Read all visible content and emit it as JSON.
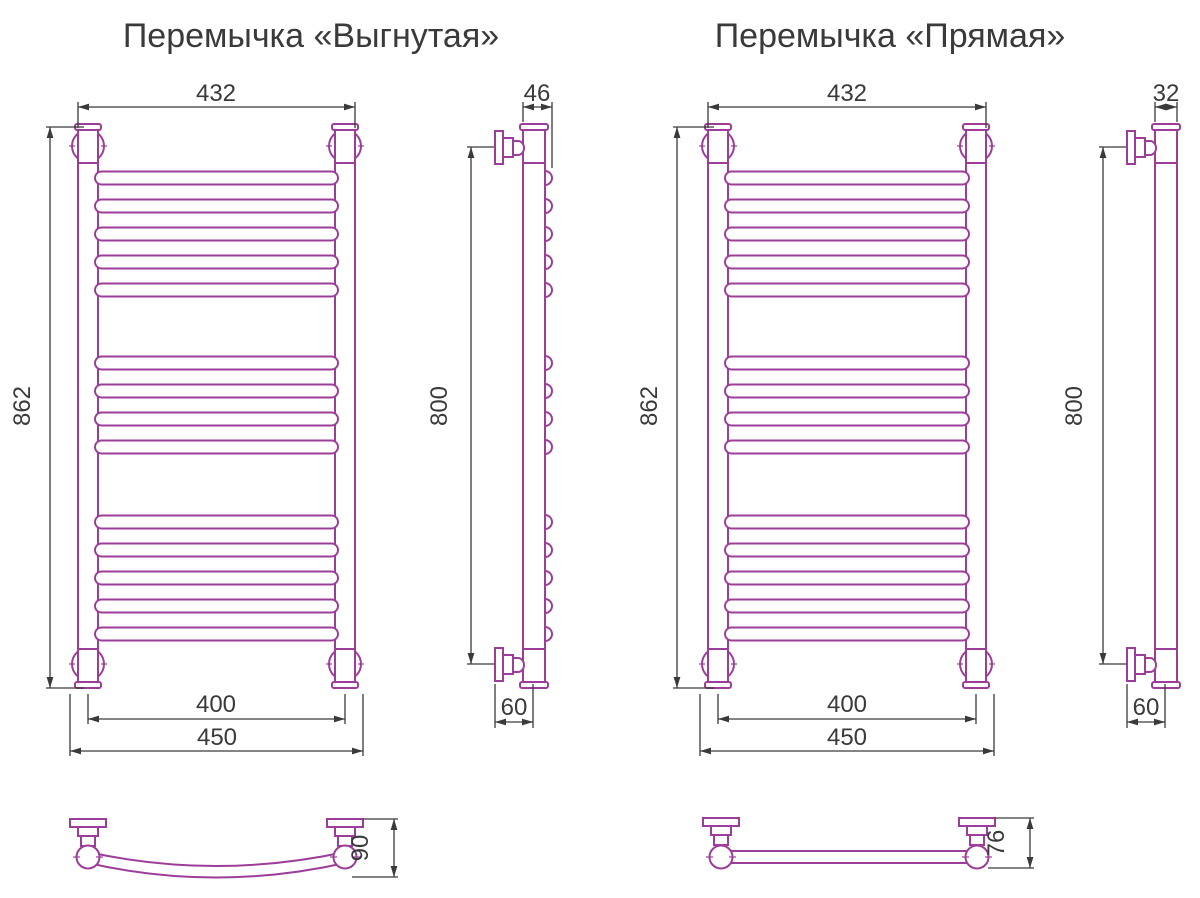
{
  "colors": {
    "drawing_outline": "#9c3e99",
    "dimension_lines": "#3a3a3a",
    "background": "#ffffff"
  },
  "curved": {
    "title": "Перемычка «Выгнутая»",
    "front": {
      "top_width": "432",
      "height": "862",
      "mount_width": "400",
      "overall_width": "450"
    },
    "side": {
      "top_depth": "46",
      "height": "800",
      "bottom_depth": "60"
    },
    "crossbar": {
      "depth": "90"
    }
  },
  "straight": {
    "title": "Перемычка «Прямая»",
    "front": {
      "top_width": "432",
      "height": "862",
      "mount_width": "400",
      "overall_width": "450"
    },
    "side": {
      "top_depth": "32",
      "height": "800",
      "bottom_depth": "60"
    },
    "crossbar": {
      "depth": "76"
    }
  }
}
